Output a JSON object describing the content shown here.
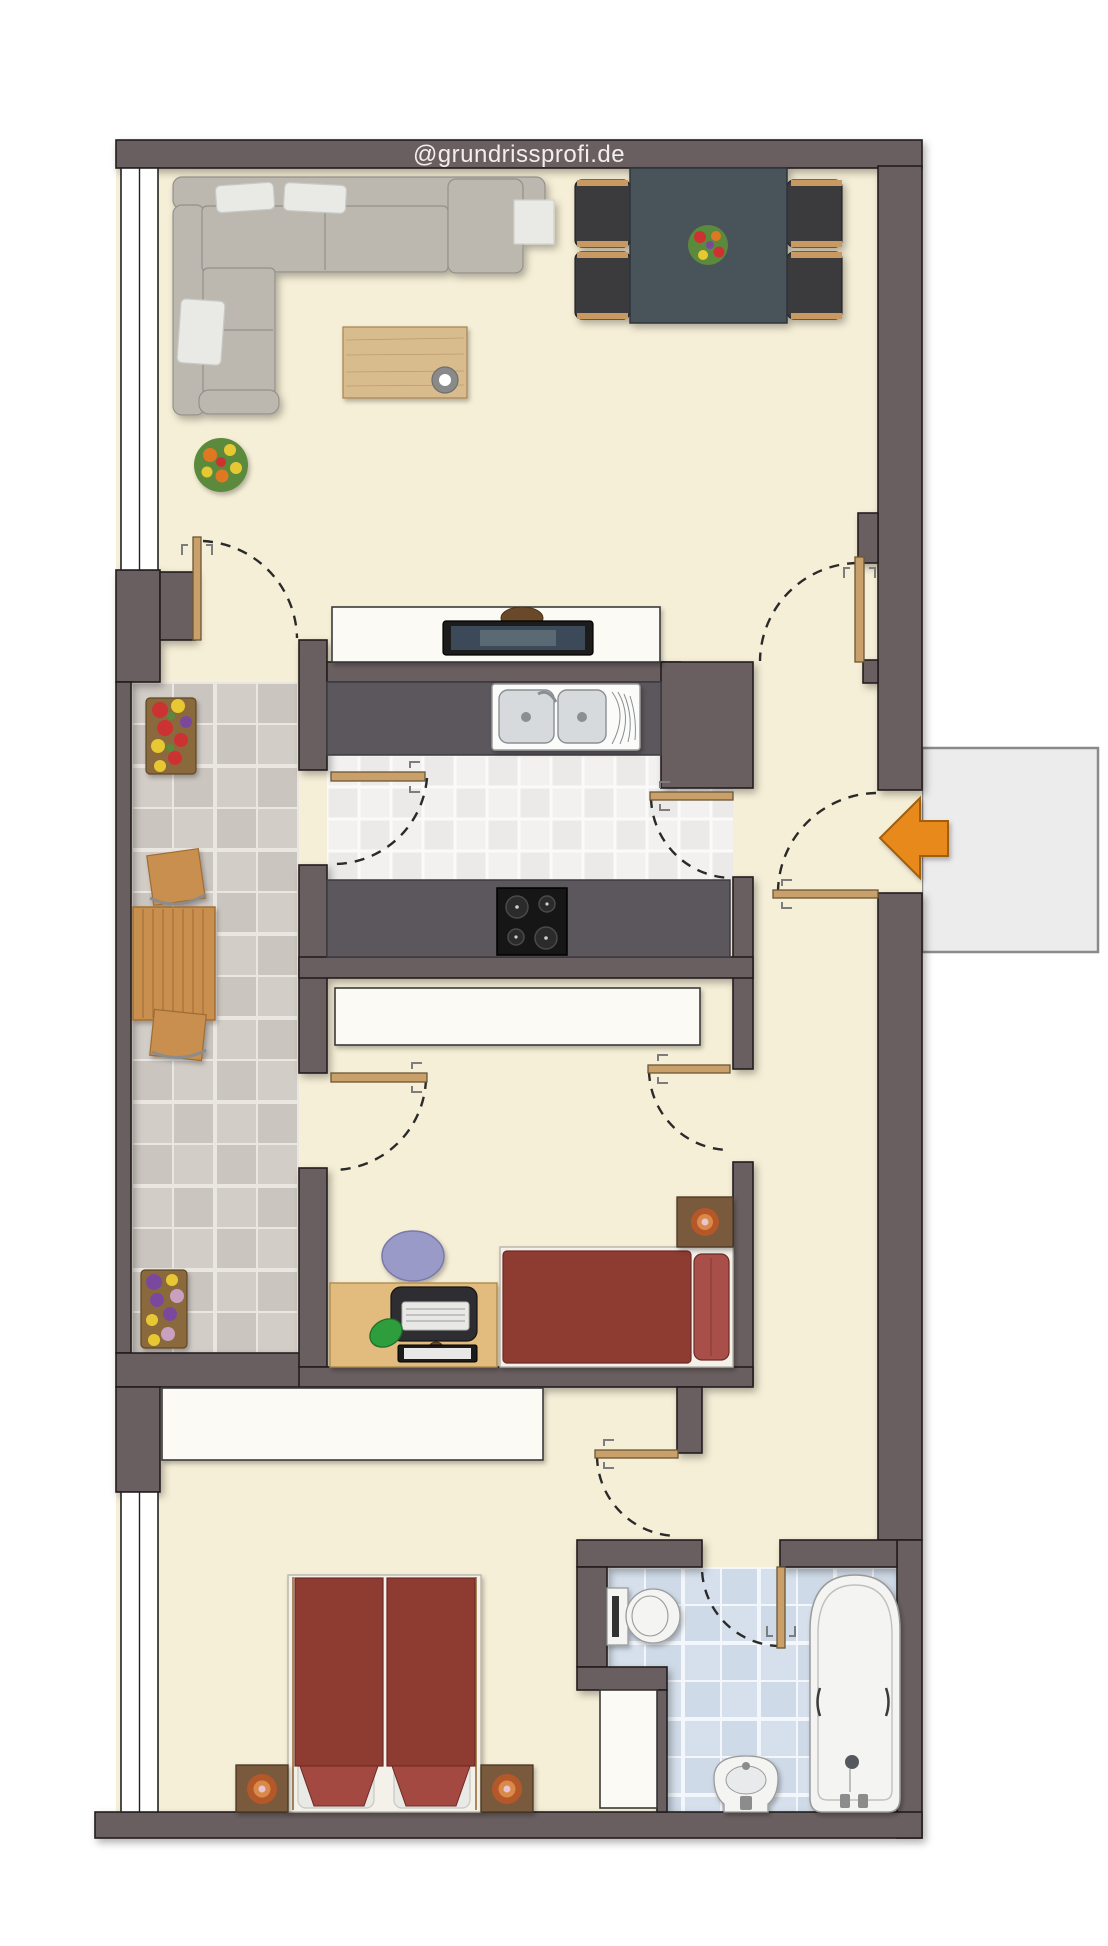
{
  "watermark": {
    "text": "@grundrissprofi.de"
  },
  "palette": {
    "pageBg": "#FFFFFF",
    "wall": "#6B5F60",
    "wallStroke": "#231F1F",
    "floor": "#F6EFD7",
    "balconyTileA": "#D3CDC7",
    "balconyTileB": "#CBC5BF",
    "balconyGrout": "#EAE6E1",
    "kitchenTileA": "#F2F1F0",
    "kitchenTileB": "#EBEAE9",
    "kitchenGrout": "#FAFAF9",
    "bathTileA": "#D6E0EC",
    "bathTileB": "#CEDAE7",
    "bathGrout": "#F3F6FA",
    "counter": "#5B575C",
    "counterStroke": "#3E3B40",
    "doorWood": "#C9A06A",
    "doorWoodStroke": "#6B5636",
    "swingArc": "#2A2A2A",
    "windowFill": "#FFFFFF",
    "windowStroke": "#222222",
    "landing": "#ECECEC",
    "landingStroke": "#8A8A8A",
    "arrow": "#E8891F",
    "arrowStroke": "#A05E0C",
    "sofa": "#BCB8B0",
    "sofaStroke": "#93908A",
    "pillowWhite": "#E9E9E6",
    "coffeeWood": "#D9BC8D",
    "coffeeWoodStroke": "#A8875A",
    "bowlGray": "#8A8A8A",
    "diningTable": "#49525A",
    "diningTableStroke": "#2F353B",
    "chairDark": "#3B3B3E",
    "chairWood": "#C89A62",
    "bedRed": "#8E3A33",
    "bedRedStroke": "#6E2A25",
    "bedRedLight": "#A34A42",
    "pillowRed": "#A85048",
    "bedBase": "#F3F1EA",
    "bedBaseStroke": "#B8B5A8",
    "deskWood": "#E2BB7E",
    "deskWoodStroke": "#B08C50",
    "nightWood": "#7A5A3C",
    "nightWoodStroke": "#4A3624",
    "bowlOuter": "#B4582A",
    "bowlMid": "#D98A4A",
    "bowlCenter": "#E9C3D6",
    "whiteBox": "#FCFAF4",
    "whiteBoxStroke": "#3A3A3A",
    "fixtureWhite": "#F4F4F2",
    "fixtureInner": "#FBFBFA",
    "fixtureStroke": "#9A9A9A",
    "steel": "#D7DADD",
    "steelStroke": "#8A8F94",
    "screenDark": "#1C1C1E",
    "screenBlue": "#3A4A58",
    "matDark": "#2E2E30",
    "keyboard": "#E8E8E6",
    "greenPill": "#2E9E3E",
    "chairLavender": "#9A9AC8",
    "chairLavenderStroke": "#7878AA",
    "stove": "#161616",
    "burner": "#2B2B2B",
    "burnerStroke": "#4A4A4A",
    "watermarkText": "#F2EFEB",
    "plantGreen": "#5C8A3C",
    "flowerRed": "#CC3333",
    "flowerYellow": "#E8C832",
    "flowerOrange": "#E07820",
    "flowerPurple": "#7A4A9E",
    "flowerPink": "#C9A0C0",
    "benchWood": "#C98F4F",
    "benchWoodStroke": "#A06C32",
    "metal": "#8C8C8C"
  }
}
